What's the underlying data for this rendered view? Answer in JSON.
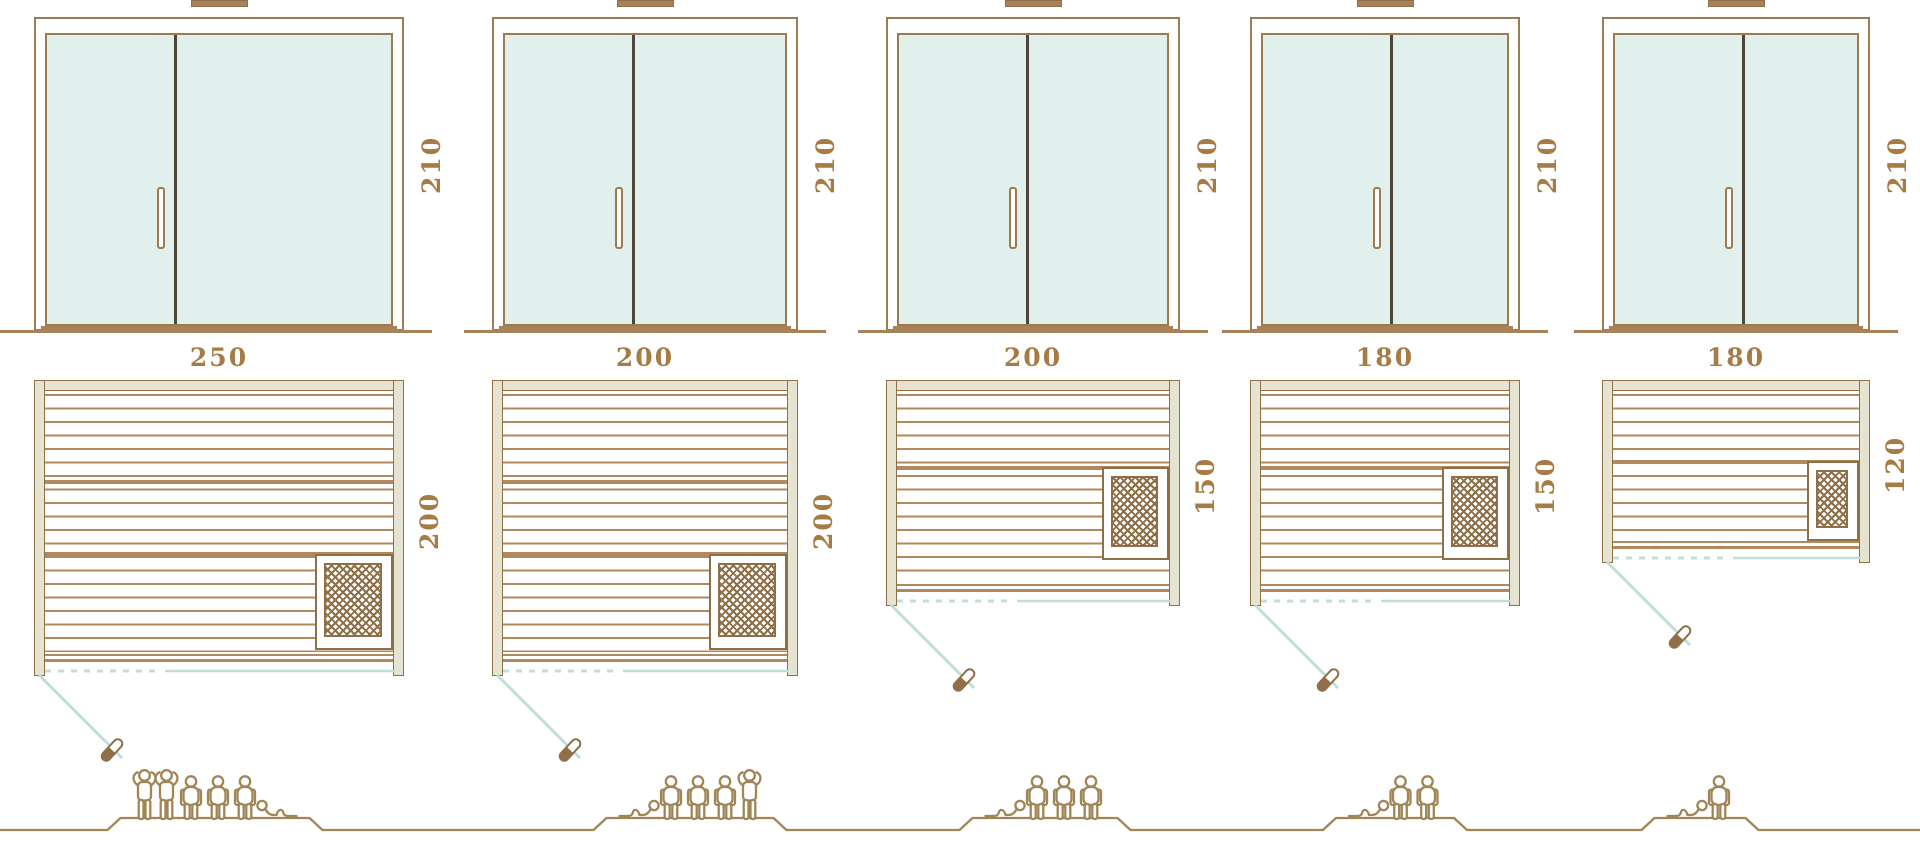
{
  "colors": {
    "background": "#ffffff",
    "outline_brown": "#8e6f47",
    "frame_brown": "#9c7b50",
    "board_tan": "#b08a5c",
    "sill_brown": "#a8835a",
    "wall_fill": "#e6e4d1",
    "glass_fill": "#e1f0ec",
    "divider_dark": "#4e463b",
    "teal_line": "#bfdfd8",
    "dimension_text": "#a57c45",
    "figure_outline": "#a08556",
    "heater_lattice": "#8e6f47"
  },
  "models": [
    {
      "door_height": "210",
      "width": "250",
      "depth": "200",
      "capacity_total": 6,
      "capacity_icons": [
        "standing",
        "standing",
        "sitting",
        "sitting",
        "sitting",
        "lying"
      ]
    },
    {
      "door_height": "210",
      "width": "200",
      "depth": "200",
      "capacity_total": 5,
      "capacity_icons": [
        "lying",
        "sitting",
        "sitting",
        "sitting",
        "standing"
      ]
    },
    {
      "door_height": "210",
      "width": "200",
      "depth": "150",
      "capacity_total": 4,
      "capacity_icons": [
        "lying",
        "sitting",
        "sitting",
        "sitting"
      ]
    },
    {
      "door_height": "210",
      "width": "180",
      "depth": "150",
      "capacity_total": 3,
      "capacity_icons": [
        "lying",
        "sitting",
        "sitting"
      ]
    },
    {
      "door_height": "210",
      "width": "180",
      "depth": "120",
      "capacity_total": 2,
      "capacity_icons": [
        "lying",
        "sitting"
      ]
    }
  ]
}
